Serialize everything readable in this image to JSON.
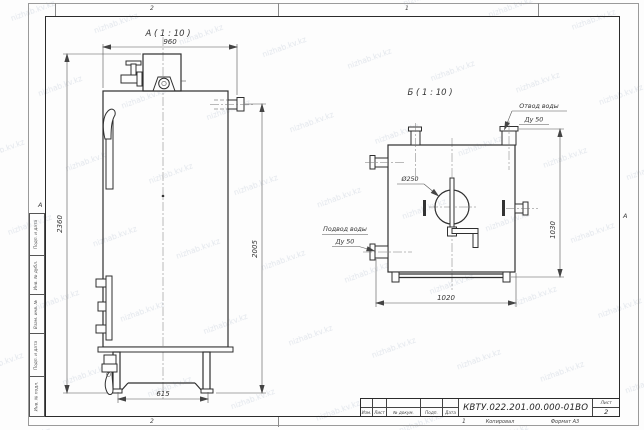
{
  "watermark": {
    "text": "nizhab.kv.kz"
  },
  "sheet": {
    "zone_top_left": "2",
    "zone_top_right": "1",
    "zone_bottom_left": "2",
    "zone_bottom_right": "1",
    "row_marker_left": "А",
    "row_marker_right": "А",
    "stamp_column": {
      "cell1": "Подп. и дата",
      "cell2": "Инв. № дубл.",
      "cell3": "Взам. инв. №",
      "cell4": "Подп. и дата",
      "cell5": "Инв. № подл."
    },
    "footer": {
      "copy": "Копировал",
      "format": "Формат А3"
    }
  },
  "title_block": {
    "doc_number": "КВТУ.022.201.00.000-01ВО",
    "sheet_label": "Лист",
    "sheet_number": "2",
    "col_izm": "Изм.",
    "col_list": "Лист",
    "col_doc": "№ докум.",
    "col_sign": "Подп.",
    "col_date": "Дата"
  },
  "view_a": {
    "label": "А ( 1 : 10 )",
    "dim_width": "960",
    "dim_height_overall": "2360",
    "dim_height_body": "2005",
    "dim_base_width": "615"
  },
  "view_b": {
    "label": "Б ( 1 : 10 )",
    "dim_width": "1020",
    "dim_height": "1030",
    "dim_burner_diameter": "Ø250",
    "outlet_note_line1": "Отвод воды",
    "outlet_note_line2": "Ду 50",
    "inlet_note_line1": "Подвод воды",
    "inlet_note_line2": "Ду 50"
  }
}
